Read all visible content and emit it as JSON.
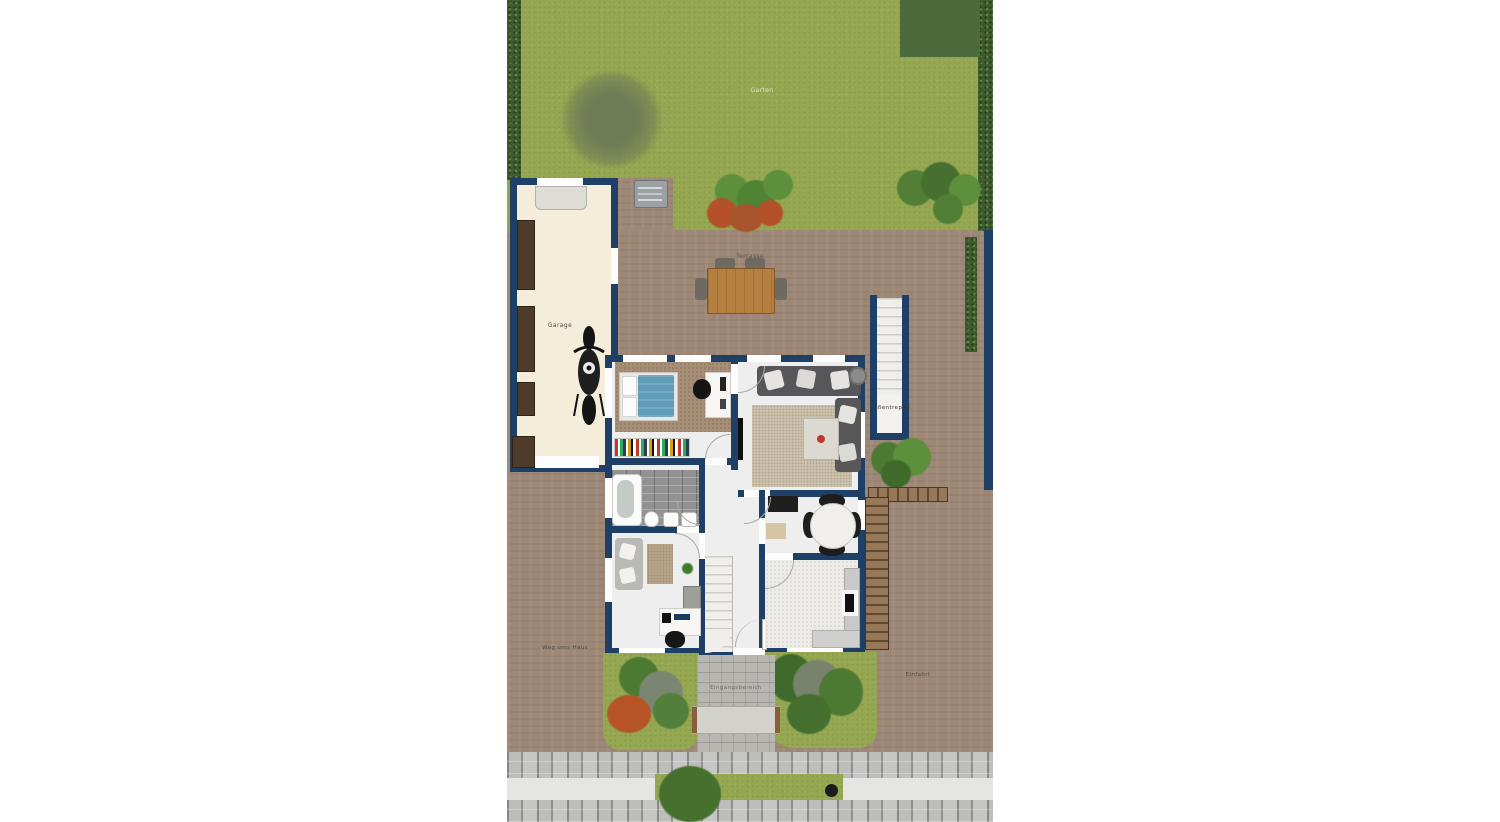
{
  "plan": {
    "labels": {
      "garden": "Garten",
      "terrace": "Terrasse",
      "garage": "Garage",
      "outdoor_staircase": "Außentreppe",
      "side_path": "Weg ums Haus",
      "entrance": "Eingangsbereich",
      "driveway": "Einfahrt"
    },
    "colors": {
      "wall_navy": "#1e3f66",
      "lawn_green": "#95a751",
      "paving_brown": "#9d8776",
      "hedge_green": "#3f5c2e",
      "garage_floor": "#f3edda",
      "room_floor": "#eeeeef",
      "bed_blue": "#5f9cb8",
      "table_wood": "#b5803f",
      "sidewalk_gray": "#9a9a98"
    }
  }
}
